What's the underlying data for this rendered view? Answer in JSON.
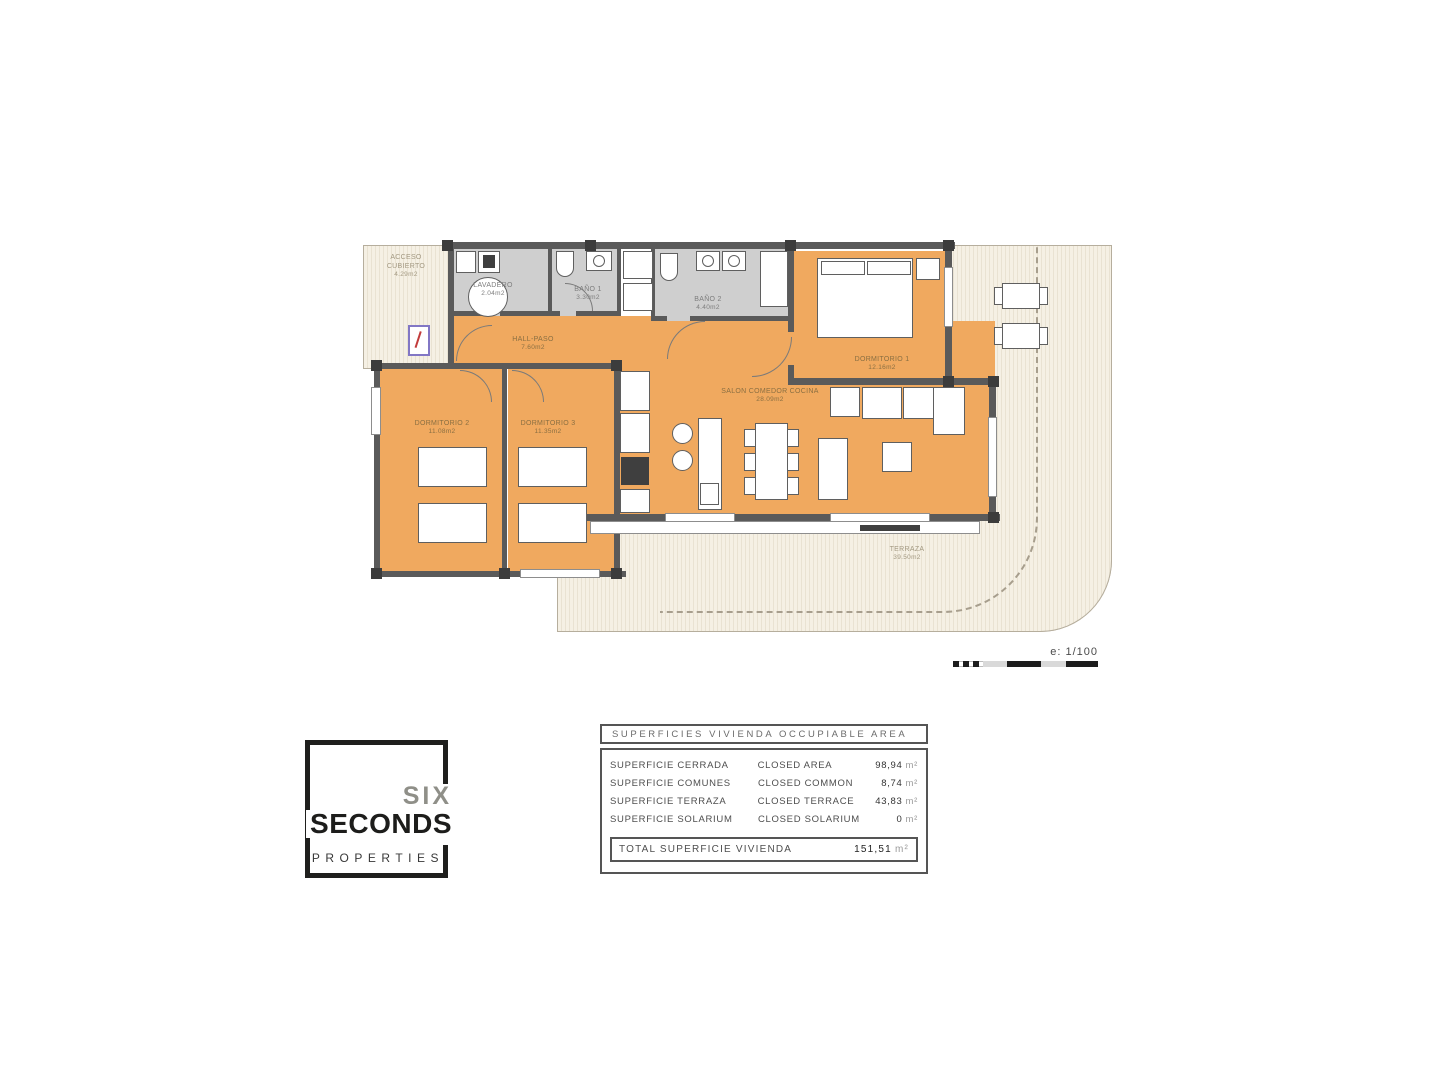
{
  "plan": {
    "scale_label": "e: 1/100",
    "rooms": {
      "acceso": {
        "name": "ACCESO CUBIERTO",
        "area": "4.29m2"
      },
      "lavadero": {
        "name": "LAVADERO",
        "area": "2.04m2"
      },
      "bano1": {
        "name": "BAÑO 1",
        "area": "3.30m2"
      },
      "bano2": {
        "name": "BAÑO 2",
        "area": "4.40m2"
      },
      "hall": {
        "name": "HALL-PASO",
        "area": "7.60m2"
      },
      "dorm1": {
        "name": "DORMITORIO 1",
        "area": "12.16m2"
      },
      "salon": {
        "name": "SALON COMEDOR COCINA",
        "area": "28.09m2"
      },
      "dorm2": {
        "name": "DORMITORIO 2",
        "area": "11.08m2"
      },
      "dorm3": {
        "name": "DORMITORIO 3",
        "area": "11.35m2"
      },
      "terraza": {
        "name": "TERRAZA",
        "area": "39.50m2"
      }
    }
  },
  "logo": {
    "line1": "SIX",
    "line2": "SECONDS",
    "line3": "PROPERTIES"
  },
  "areas_table": {
    "title": "SUPERFICIES  VIVIENDA  OCCUPIABLE  AREA",
    "rows": [
      {
        "es": "SUPERFICIE  CERRADA",
        "en": "CLOSED  AREA",
        "value": "98,94",
        "unit": "m²"
      },
      {
        "es": "SUPERFICIE  COMUNES",
        "en": "CLOSED  COMMON",
        "value": "8,74",
        "unit": "m²"
      },
      {
        "es": "SUPERFICIE  TERRAZA",
        "en": "CLOSED  TERRACE",
        "value": "43,83",
        "unit": "m²"
      },
      {
        "es": "SUPERFICIE  SOLARIUM",
        "en": "CLOSED  SOLARIUM",
        "value": "0",
        "unit": "m²"
      }
    ],
    "total": {
      "label": "TOTAL  SUPERFICIE  VIVIENDA",
      "value": "151,51",
      "unit": "m²"
    }
  }
}
